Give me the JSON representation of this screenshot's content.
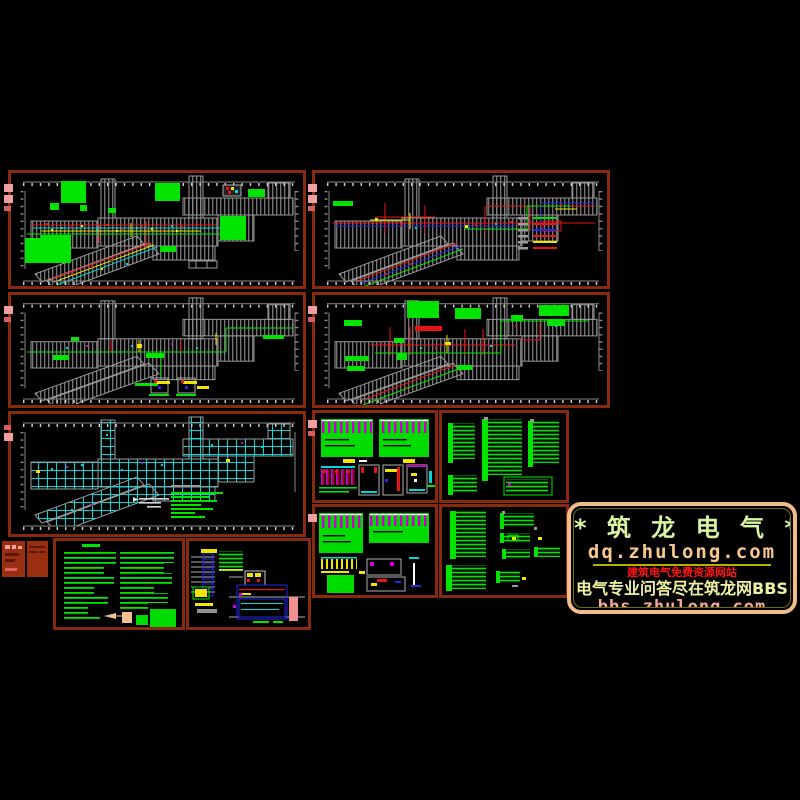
{
  "page": {
    "background": "#000000",
    "description_kind": "CAD electrical drawing sheet preview"
  },
  "logo": {
    "title": "* 筑 龙 电 气 *",
    "url_primary": "dq.zhulong.com",
    "banner_red": "建筑电气免费资源网站",
    "banner_main": "电气专业问答尽在筑龙网BBS",
    "url_secondary": "bbs.zhulong.com"
  },
  "palette": {
    "background": "#000000",
    "panel_border": "#872a10",
    "stamp_fill": "#9a2e10",
    "mark_salmon": "#efa0a0",
    "cad_gray": "#9a9a9a",
    "cad_white": "#d8d8d8",
    "cad_green": "#00e400",
    "cad_cyan": "#00d8d8",
    "cad_red": "#e81414",
    "cad_yellow": "#f0e400",
    "cad_blue": "#2428e8",
    "cad_magenta": "#cc00cc",
    "cad_pink": "#f09090",
    "logo_border": "#f2bc88",
    "logo_inner_line": "#6f6f00",
    "logo_title": "#d9f6a2",
    "logo_url_primary": "#f6c78e",
    "logo_rule": "#b2b200",
    "logo_banner_red": "#ff1212",
    "logo_banner_main": "#edf3a3",
    "logo_url_secondary": "#f2a89a"
  },
  "panels": [
    {
      "id": "floor-plan-1",
      "kind": "floor-plan"
    },
    {
      "id": "floor-plan-2",
      "kind": "floor-plan-with-legend"
    },
    {
      "id": "floor-plan-3",
      "kind": "floor-plan"
    },
    {
      "id": "floor-plan-4",
      "kind": "floor-plan"
    },
    {
      "id": "grid-plan",
      "kind": "floor-plan-grid"
    },
    {
      "id": "panel-schedules-1",
      "kind": "distribution-panels"
    },
    {
      "id": "riser-diagrams-1",
      "kind": "system-diagrams"
    },
    {
      "id": "panel-schedules-2",
      "kind": "distribution-panels"
    },
    {
      "id": "riser-diagrams-2",
      "kind": "system-diagrams"
    },
    {
      "id": "notes-sheet",
      "kind": "text-notes"
    },
    {
      "id": "detail-schematic",
      "kind": "wiring-detail"
    },
    {
      "id": "stamp-strip-1",
      "kind": "title-stamp"
    },
    {
      "id": "stamp-strip-2",
      "kind": "title-stamp"
    }
  ]
}
